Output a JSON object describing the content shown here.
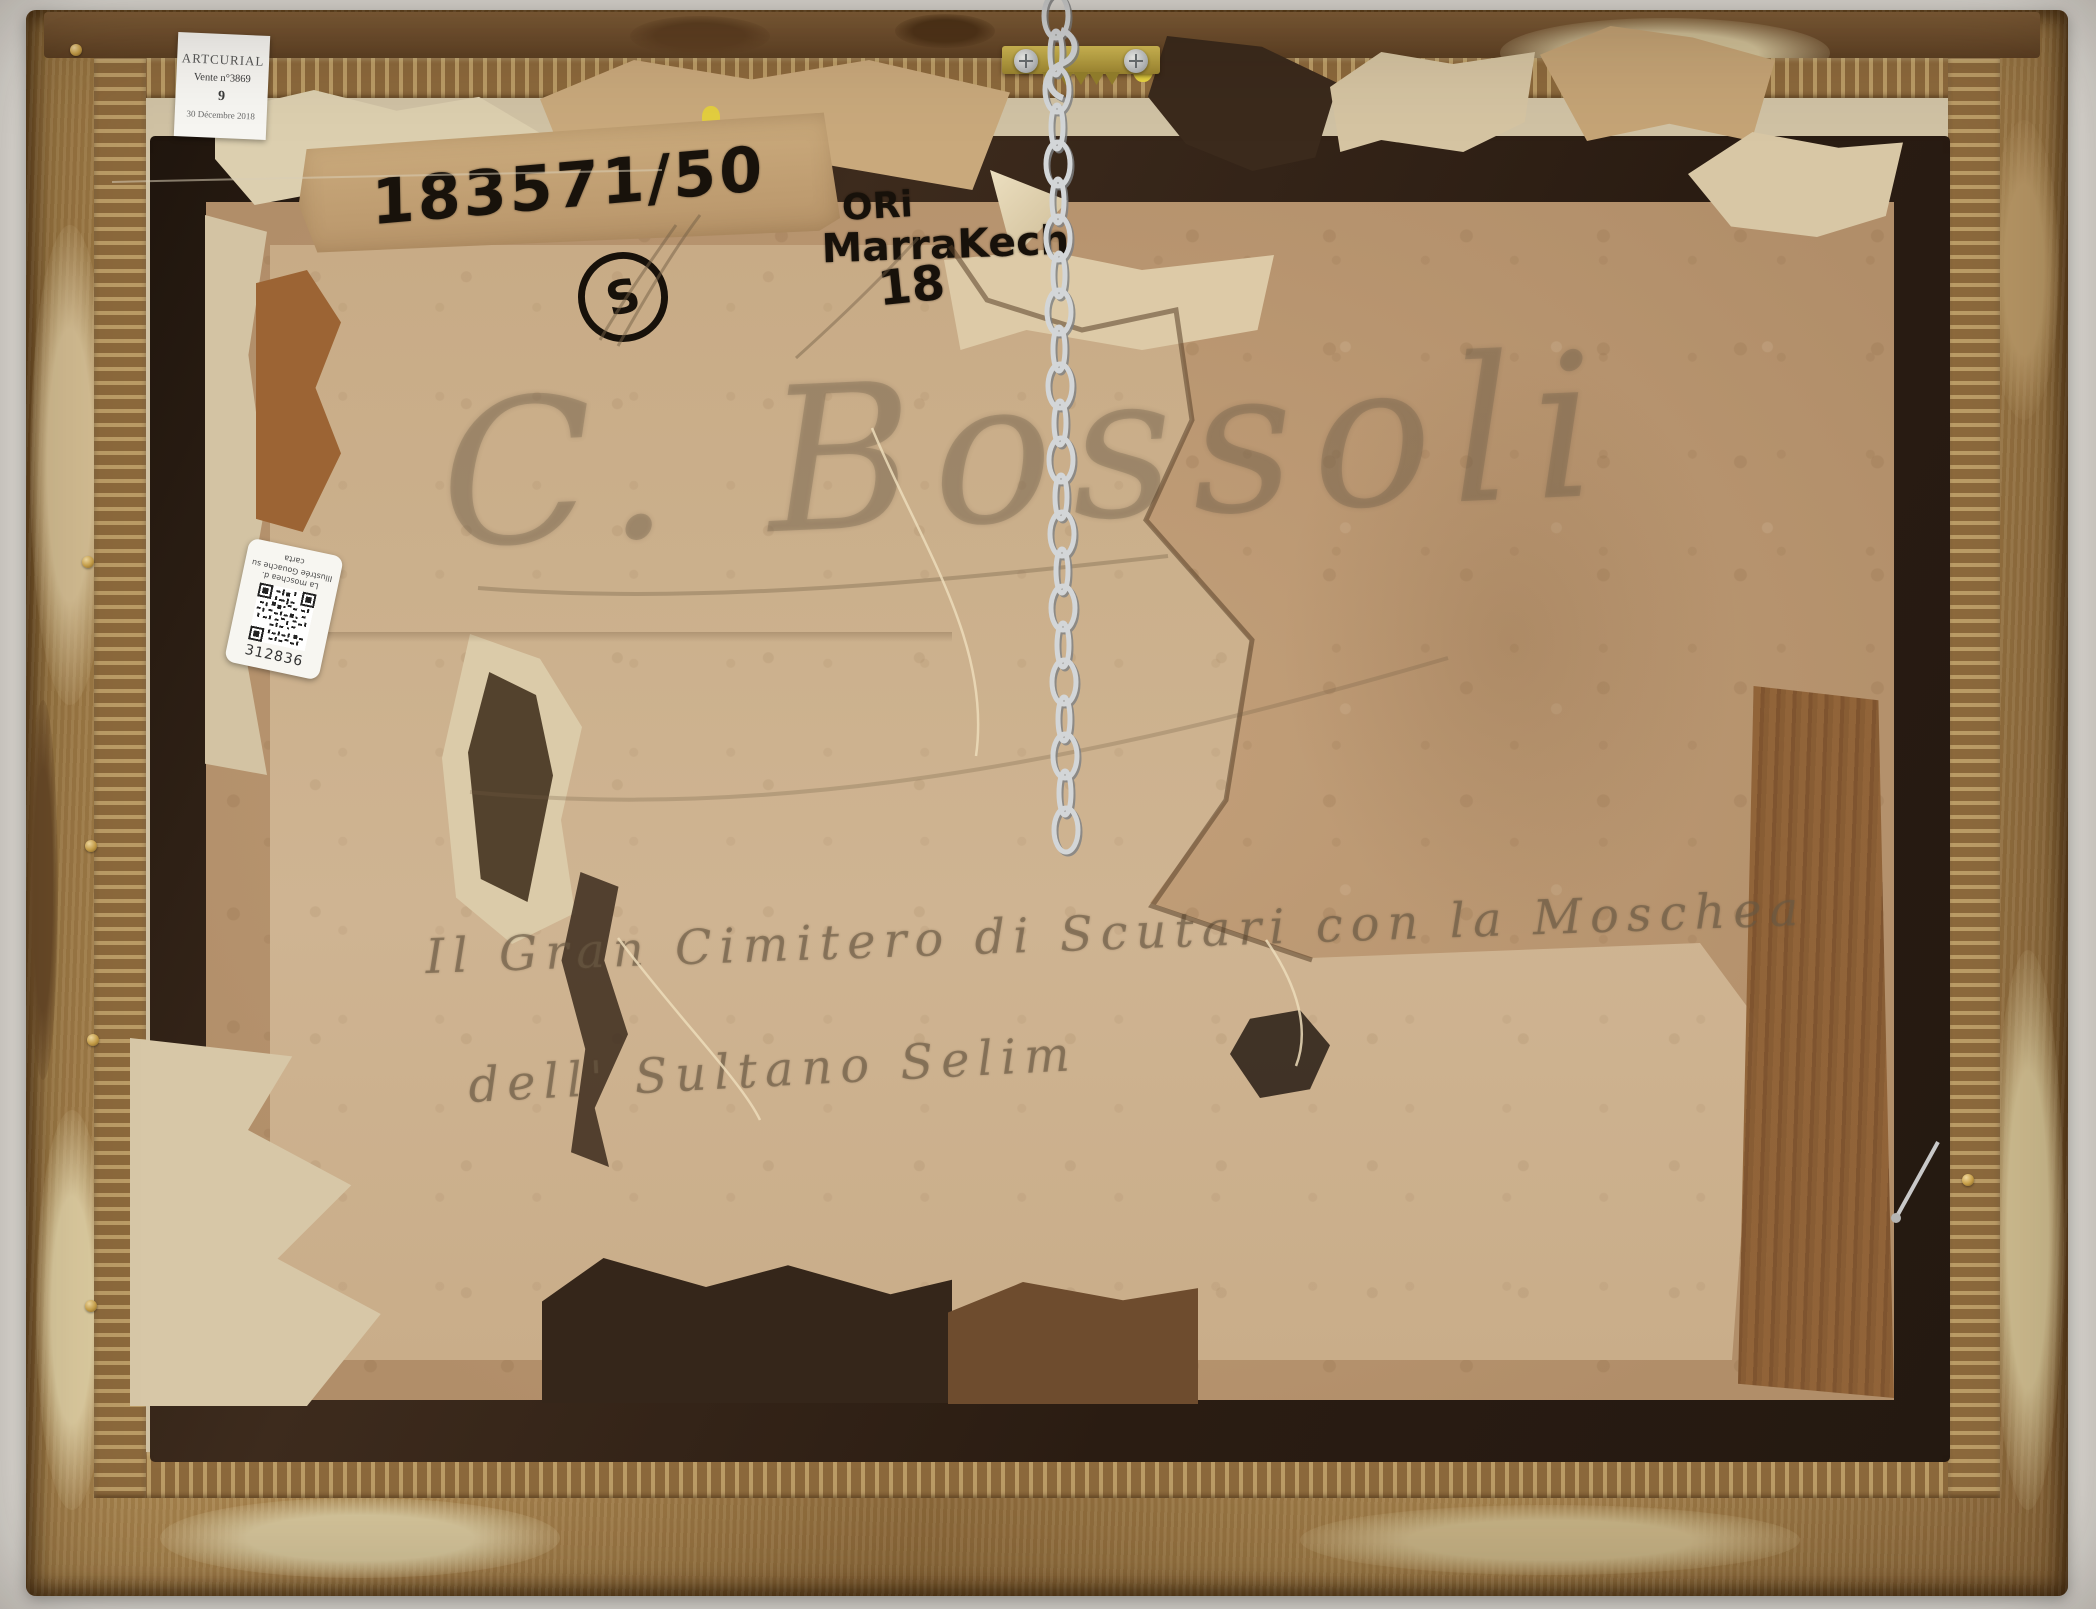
{
  "scene": "Verso of a framed painting: worn gilt frame, torn backing board, hanging chain and dealer labels",
  "labels": {
    "auction": {
      "house": "ARTCURIAL",
      "sale": "Vente n°3869",
      "lot": "9",
      "date": "30 Décembre 2018"
    },
    "inventory_sticker": {
      "lines": [
        "La moschea d.",
        "Illustrée Gouache su",
        "carta"
      ],
      "number": "312836"
    }
  },
  "inscriptions": {
    "tape_number": "183571/50",
    "circled_letter": "S",
    "marker": {
      "line1": "ORi",
      "line2": "MarraKech",
      "line3": "18"
    },
    "pencil_signature": "C. Bossoli",
    "pencil_title_line1": "Il Gran Cimitero di Scutari con la Moschea",
    "pencil_title_line2": "dell' Sultano Selim"
  },
  "icons": {
    "hanger": "sawtooth-hanger",
    "chain": "metal-chain",
    "screw": "phillips-screw",
    "tack": "brass-tack",
    "nail": "bent-nail",
    "qr": "qr-code"
  },
  "colors": {
    "frame_gold": "#a5824c",
    "backing_tan": "#bb9873",
    "panel_light": "#cdb392",
    "dark_lip": "#2b1e14",
    "marker_ink": "#17110a",
    "pencil": "#8f7a62",
    "tape": "#c2a174",
    "label_bg": "#f6f5f1",
    "chain_silver": "#cfd2d4",
    "brass": "#b7a23c"
  }
}
